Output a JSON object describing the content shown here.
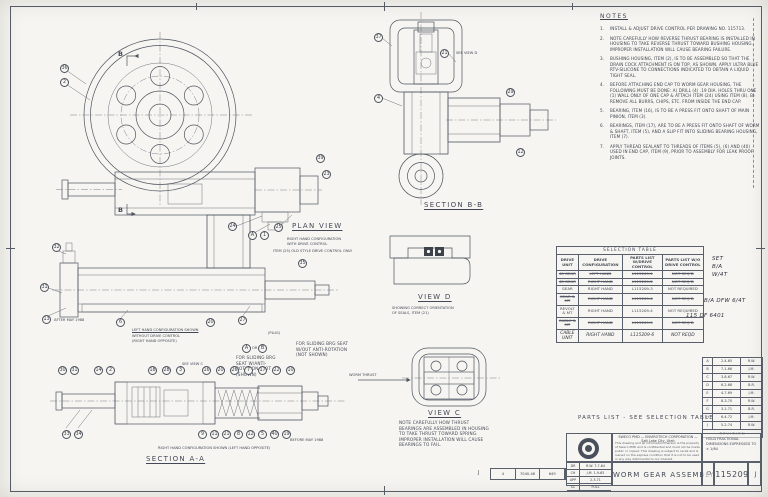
{
  "labels": {
    "plan_view": "PLAN VIEW",
    "plan_cap1": "RIGHT HAND CONFIGURATION",
    "plan_cap2": "WITH DRIVE CONTROL",
    "section_bb": "SECTION B-B",
    "see_view_d": "SEE VIEW D",
    "view_d": "VIEW D",
    "view_d_cap1": "SHOWING CORRECT ORIENTATION",
    "view_d_cap2": "OF SEALS, ITEM (21)",
    "view_c": "VIEW C",
    "view_c_cap": "NOTE CAREFULLY HOW THRUST BEARINGS ARE ASSEMBLED IN HOUSING TO TAKE THRUST TOWARD SPRING. IMPROPER INSTALLATION WILL CAUSE BEARINGS TO FAIL.",
    "worm_thrust": "WORM THRUST",
    "item25_note": "ITEM (25) OLD STYLE DRIVE CONTROL ONLY",
    "left_cfg1": "LEFT HAND CONFIGURATION SHOWN",
    "left_cfg2": "WITHOUT DRIVE CONTROL",
    "left_cfg3": "(RIGHT HAND OPPOSITE)",
    "see_view_c": "SEE VIEW C",
    "plug": "(PLUG)",
    "or_word": "OR",
    "seat_note_a": "FOR SLIDING BRG SEAT W/ANTI-ROTATION SLOT (SHOWN)",
    "seat_note_b": "FOR SLIDING BRG SEAT W/OUT ANTI-ROTATION (NOT SHOWN)",
    "after_may": "AFTER MAY 1988",
    "before_may": "BEFORE MAY 1988",
    "section_aa": "SECTION A-A",
    "section_aa_cap": "RIGHT HAND CONFIGURATION SHOWN (LEFT HAND OPPOSITE)",
    "cut_b": "B"
  },
  "notes": {
    "heading": "NOTES",
    "items": [
      {
        "n": "1.",
        "text": "INSTALL & ADJUST DRIVE CONTROL PER DRAWING NO. 115713."
      },
      {
        "n": "2.",
        "text": "NOTE CAREFULLY HOW REVERSE THRUST BEARING IS INSTALLED IN HOUSING TO TAKE REVERSE THRUST TOWARD BUSHING HOUSING. IMPROPER INSTALLATION WILL CAUSE BEARING FAILURE."
      },
      {
        "n": "3.",
        "text": "BUSHING HOUSING, ITEM (2), IS TO BE ASSEMBLED SO THAT THE DRAIN COCK ATTACHMENT IS ON TOP, AS SHOWN. APPLY ULTRA BLUE RTV-SILICONE TO CONNECTIONS INDICATED TO OBTAIN A LIQUID TIGHT SEAL."
      },
      {
        "n": "4.",
        "text": "BEFORE ATTACHING END CAP TO WORM GEAR HOUSING, THE FOLLOWING MUST BE DONE: A) DRILL (4) .19 DIA. HOLES THRU ONE (1) WALL ONLY OF ONE CAP & ATTACH ITEM (24) USING ITEM (8). B) REMOVE ALL BURRS, CHIPS, ETC. FROM INSIDE THE END CAP."
      },
      {
        "n": "5.",
        "text": "BEARING, ITEM (16), IS TO BE A PRESS FIT ONTO SHAFT OF MAIN PINION, ITEM (3)."
      },
      {
        "n": "6.",
        "text": "BEARINGS, ITEM (17), ARE TO BE A PRESS FIT ONTO SHAFT OF WORM & SHAFT, ITEM (5), AND A SLIP FIT INTO SLIDING BEARING HOUSING, ITEM (7)."
      },
      {
        "n": "7.",
        "text": "APPLY THREAD SEALANT TO THREADS OF ITEMS (5), (6) AND (40) USED IN END CAP, ITEM (9), PRIOR TO ASSEMBLY FOR LEAK PROOF JOINTS."
      }
    ]
  },
  "selection_table": {
    "title": "SELECTION TABLE",
    "col_headers": [
      "DRIVE UNIT",
      "DRIVE CONFIGURATION",
      "PARTS LIST W/DRIVE CONTROL",
      "PARTS LIST W/O DRIVE CONTROL"
    ],
    "rows": [
      {
        "cells": [
          "48 GEAR",
          "LEFT HAND",
          "L115209-1",
          "NOT REQ'D"
        ],
        "struck": true,
        "hand": false
      },
      {
        "cells": [
          "48 GEAR",
          "RIGHT HAND",
          "L115209-2",
          "NOT REQ'D"
        ],
        "struck": true,
        "hand": false
      },
      {
        "cells": [
          "GEAR",
          "RIGHT HAND",
          "L115209-3",
          "NOT REQUIRED"
        ],
        "struck": false,
        "hand": false
      },
      {
        "cells": [
          "GEAR & MT",
          "RIGHT HAND",
          "L115209-4",
          "NOT REQ'D"
        ],
        "struck": true,
        "hand": false
      },
      {
        "cells": [
          "REVOLT & MT",
          "RIGHT HAND",
          "L115209-4",
          "NOT REQUIRED"
        ],
        "struck": false,
        "hand": false
      },
      {
        "cells": [
          "CABLE & MT",
          "RIGHT HAND",
          "L115209-5",
          "NOT REQ'D"
        ],
        "struck": true,
        "hand": false
      },
      {
        "cells": [
          "CABLE UNIT",
          "RIGHT HAND",
          "L115209-6",
          "NOT REQD",
          ""
        ],
        "struck": false,
        "hand": true
      }
    ]
  },
  "hand_notes": {
    "a1": "SET",
    "a2": "B/A",
    "a3": "W/4T",
    "b": "B/A DFW 6/4T",
    "c": "115 DF 6401"
  },
  "revision_table": {
    "footer": "REVISION",
    "rows": [
      [
        "A",
        "2-4-65",
        "R.W."
      ],
      [
        "B",
        "7-1-66",
        "J.M."
      ],
      [
        "C",
        "3-8-67",
        "R.W."
      ],
      [
        "D",
        "6-2-68",
        "B.R."
      ],
      [
        "E",
        "4-7-69",
        "J.M."
      ],
      [
        "F",
        "8-3-70",
        "R.W."
      ],
      [
        "G",
        "3-1-71",
        "B.R."
      ],
      [
        "H",
        "6-4-72",
        "J.M."
      ],
      [
        "J",
        "5-2-74",
        "R.W."
      ]
    ]
  },
  "title_block": {
    "parts_note": "PARTS LIST - SEE SELECTION TABLE",
    "company_line": "SWECO PMD — ENVIROTECH CORPORATION — Salt Lake City, Utah",
    "disclaimer": "This drawing and all information thereon is the property of Sweco PMD and is confidential and must not be made public or copied. This drawing is subject to recall and is loaned on the express condition that it is not to be used in any way detrimental to our interest.",
    "tolerance_note": "HOLD FRACTIONAL DIMENSIONS EXPRESSED TO ± 1/64",
    "title": "WORM GEAR ASSEMBLY",
    "size": "D",
    "drawing_number": "115209",
    "revision": "J",
    "ref_stamp": "J",
    "approvals": [
      [
        "DR",
        "R.W. 7-7-64"
      ],
      [
        "CH",
        "J.M. 1-9-65"
      ],
      [
        "APP",
        "2-3-71"
      ],
      [
        "SC",
        "FULL"
      ]
    ],
    "ref_cells": [
      "4",
      "7040-46",
      "649"
    ]
  },
  "balloons": [
    {
      "n": "36",
      "x": 60,
      "y": 64
    },
    {
      "n": "2",
      "x": 60,
      "y": 78
    },
    {
      "n": "24",
      "x": 228,
      "y": 222
    },
    {
      "n": "A",
      "x": 248,
      "y": 231
    },
    {
      "n": "1",
      "x": 260,
      "y": 231
    },
    {
      "n": "25",
      "x": 274,
      "y": 223
    },
    {
      "n": "39",
      "x": 316,
      "y": 154
    },
    {
      "n": "23",
      "x": 322,
      "y": 170
    },
    {
      "n": "21",
      "x": 440,
      "y": 49
    },
    {
      "n": "37",
      "x": 374,
      "y": 33
    },
    {
      "n": "4",
      "x": 374,
      "y": 94
    },
    {
      "n": "29",
      "x": 506,
      "y": 88
    },
    {
      "n": "12",
      "x": 516,
      "y": 148
    },
    {
      "n": "31",
      "x": 40,
      "y": 283
    },
    {
      "n": "13",
      "x": 42,
      "y": 315
    },
    {
      "n": "32",
      "x": 52,
      "y": 243
    },
    {
      "n": "6",
      "x": 116,
      "y": 318
    },
    {
      "n": "20",
      "x": 206,
      "y": 318
    },
    {
      "n": "27",
      "x": 238,
      "y": 316
    },
    {
      "n": "35",
      "x": 298,
      "y": 259
    },
    {
      "n": "A",
      "x": 242,
      "y": 344
    },
    {
      "n": "B",
      "x": 258,
      "y": 344
    },
    {
      "n": "30",
      "x": 58,
      "y": 366
    },
    {
      "n": "31",
      "x": 70,
      "y": 366
    },
    {
      "n": "14",
      "x": 94,
      "y": 366
    },
    {
      "n": "2",
      "x": 106,
      "y": 366
    },
    {
      "n": "18",
      "x": 148,
      "y": 366
    },
    {
      "n": "28",
      "x": 162,
      "y": 366
    },
    {
      "n": "3",
      "x": 176,
      "y": 366
    },
    {
      "n": "16",
      "x": 202,
      "y": 366
    },
    {
      "n": "20",
      "x": 216,
      "y": 366
    },
    {
      "n": "26",
      "x": 230,
      "y": 366
    },
    {
      "n": "7",
      "x": 244,
      "y": 366
    },
    {
      "n": "17",
      "x": 258,
      "y": 366
    },
    {
      "n": "22",
      "x": 272,
      "y": 366
    },
    {
      "n": "10",
      "x": 286,
      "y": 366
    },
    {
      "n": "33",
      "x": 62,
      "y": 430
    },
    {
      "n": "34",
      "x": 74,
      "y": 430
    },
    {
      "n": "9",
      "x": 198,
      "y": 430
    },
    {
      "n": "11",
      "x": 210,
      "y": 430
    },
    {
      "n": "21",
      "x": 222,
      "y": 430
    },
    {
      "n": "8",
      "x": 234,
      "y": 430
    },
    {
      "n": "12",
      "x": 246,
      "y": 430
    },
    {
      "n": "5",
      "x": 258,
      "y": 430
    },
    {
      "n": "40",
      "x": 270,
      "y": 430
    },
    {
      "n": "19",
      "x": 282,
      "y": 430
    }
  ]
}
